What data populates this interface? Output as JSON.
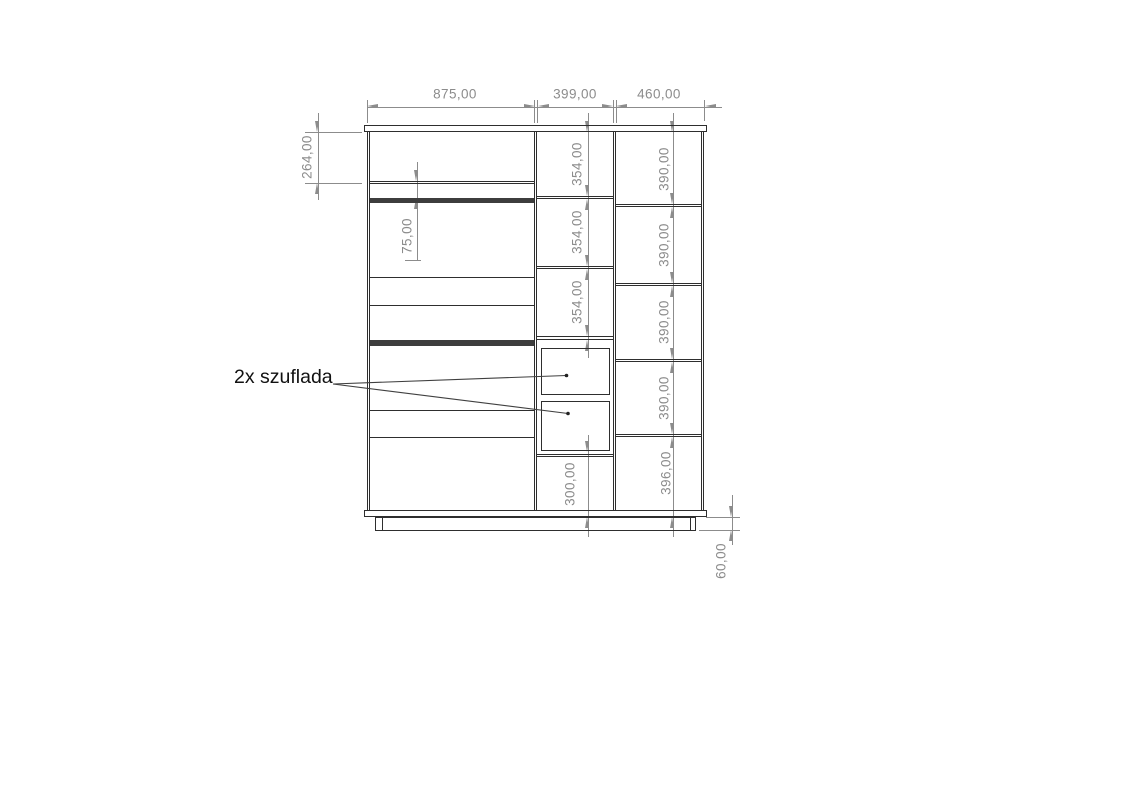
{
  "dims": {
    "top_widths": [
      "875,00",
      "399,00",
      "460,00"
    ],
    "upper_left_height": "264,00",
    "niche_gap": "75,00",
    "middle_shelf_heights": [
      "354,00",
      "354,00",
      "354,00"
    ],
    "middle_bottom_height": "300,00",
    "right_shelf_heights": [
      "390,00",
      "390,00",
      "390,00",
      "390,00"
    ],
    "right_bottom_height": "396,00",
    "plinth_height": "60,00"
  },
  "callout": {
    "drawers_label": "2x szuflada"
  },
  "colors": {
    "cabinet_line": "#2e2e2e",
    "dimension": "#8c8c8c",
    "label": "#111111",
    "background": "#ffffff"
  }
}
